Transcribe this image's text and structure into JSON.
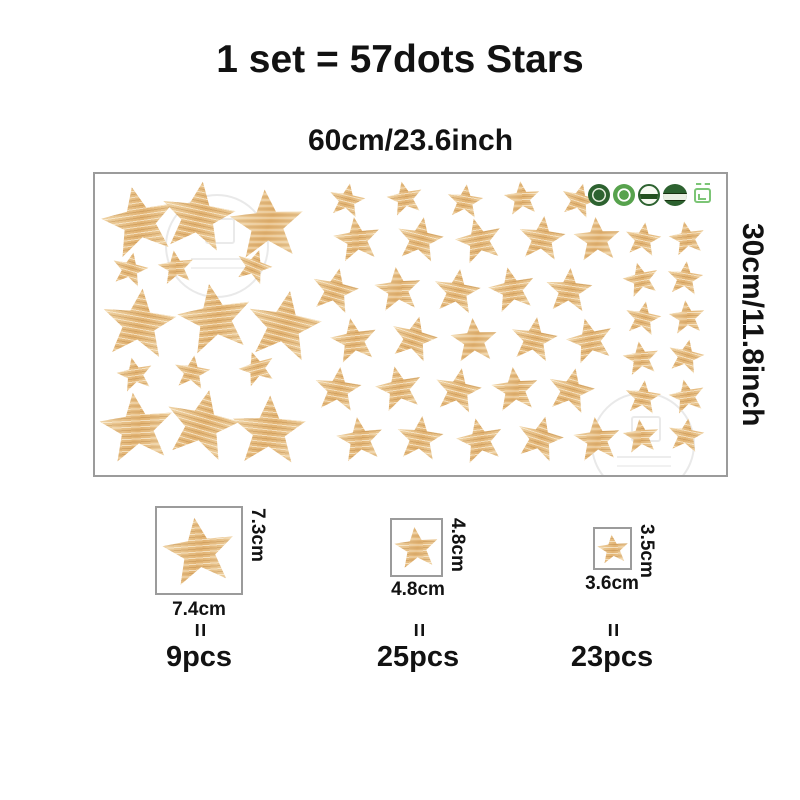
{
  "title": "1 set = 57dots Stars",
  "sheet_width_label": "60cm/23.6inch",
  "sheet_height_label": "30cm/11.8inch",
  "colors": {
    "star_base": "#e2b373",
    "star_light": "#f2dcb4",
    "badge_green_dark": "#2d6230",
    "badge_green_mid": "#57a24d",
    "badge_green_light": "#7cc576",
    "border_gray": "#9b9b9b"
  },
  "badges": {
    "icons": [
      "eco-seal-dark-icon",
      "eco-seal-green-icon",
      "eco-seal-outline-icon",
      "eco-seal-banner-icon",
      "package-cert-icon"
    ]
  },
  "sheet": {
    "star_sizes_px": {
      "l": 76,
      "m": 48,
      "s": 37
    },
    "stars": [
      {
        "x": 6.9,
        "y": 15.5,
        "s": "l",
        "r": -12
      },
      {
        "x": 16.4,
        "y": 14.0,
        "s": "l",
        "r": 8
      },
      {
        "x": 27.2,
        "y": 16.5,
        "s": "l",
        "r": -4
      },
      {
        "x": 7.0,
        "y": 49.5,
        "s": "l",
        "r": 6
      },
      {
        "x": 19.0,
        "y": 48.0,
        "s": "l",
        "r": -10
      },
      {
        "x": 30.0,
        "y": 50.0,
        "s": "l",
        "r": 10
      },
      {
        "x": 6.7,
        "y": 84.0,
        "s": "l",
        "r": -7
      },
      {
        "x": 16.9,
        "y": 83.0,
        "s": "l",
        "r": 12
      },
      {
        "x": 27.6,
        "y": 85.0,
        "s": "l",
        "r": 2
      },
      {
        "x": 5.5,
        "y": 31.5,
        "s": "s",
        "r": 12
      },
      {
        "x": 12.8,
        "y": 31.0,
        "s": "s",
        "r": -8
      },
      {
        "x": 25.2,
        "y": 30.5,
        "s": "s",
        "r": 18
      },
      {
        "x": 6.3,
        "y": 66.5,
        "s": "s",
        "r": -12
      },
      {
        "x": 15.3,
        "y": 65.8,
        "s": "s",
        "r": 8
      },
      {
        "x": 25.7,
        "y": 64.5,
        "s": "s",
        "r": -18
      },
      {
        "x": 40.0,
        "y": 8.5,
        "s": "s",
        "r": 10
      },
      {
        "x": 49.1,
        "y": 8.0,
        "s": "s",
        "r": -12
      },
      {
        "x": 58.6,
        "y": 9.0,
        "s": "s",
        "r": 6
      },
      {
        "x": 67.7,
        "y": 8.0,
        "s": "s",
        "r": -6
      },
      {
        "x": 76.7,
        "y": 8.5,
        "s": "s",
        "r": 14
      },
      {
        "x": 41.6,
        "y": 21.5,
        "s": "m",
        "r": -8
      },
      {
        "x": 51.5,
        "y": 21.5,
        "s": "m",
        "r": 10
      },
      {
        "x": 60.9,
        "y": 21.8,
        "s": "m",
        "r": -14
      },
      {
        "x": 70.9,
        "y": 21.3,
        "s": "m",
        "r": 6
      },
      {
        "x": 79.5,
        "y": 21.6,
        "s": "m",
        "r": -4
      },
      {
        "x": 38.1,
        "y": 38.5,
        "s": "m",
        "r": 12
      },
      {
        "x": 48.0,
        "y": 38.2,
        "s": "m",
        "r": -6
      },
      {
        "x": 57.3,
        "y": 38.8,
        "s": "m",
        "r": 8
      },
      {
        "x": 66.1,
        "y": 38.3,
        "s": "m",
        "r": -12
      },
      {
        "x": 75.1,
        "y": 38.6,
        "s": "m",
        "r": 4
      },
      {
        "x": 41.0,
        "y": 55.0,
        "s": "m",
        "r": -10
      },
      {
        "x": 50.5,
        "y": 54.6,
        "s": "m",
        "r": 14
      },
      {
        "x": 60.0,
        "y": 55.2,
        "s": "m",
        "r": -4
      },
      {
        "x": 69.5,
        "y": 54.8,
        "s": "m",
        "r": 8
      },
      {
        "x": 78.5,
        "y": 55.1,
        "s": "m",
        "r": -14
      },
      {
        "x": 38.5,
        "y": 71.5,
        "s": "m",
        "r": 6
      },
      {
        "x": 48.2,
        "y": 71.2,
        "s": "m",
        "r": -12
      },
      {
        "x": 57.5,
        "y": 71.8,
        "s": "m",
        "r": 10
      },
      {
        "x": 66.5,
        "y": 71.3,
        "s": "m",
        "r": -6
      },
      {
        "x": 75.5,
        "y": 71.6,
        "s": "m",
        "r": 12
      },
      {
        "x": 42.0,
        "y": 88.0,
        "s": "m",
        "r": -8
      },
      {
        "x": 51.5,
        "y": 87.6,
        "s": "m",
        "r": 6
      },
      {
        "x": 61.0,
        "y": 88.3,
        "s": "m",
        "r": -12
      },
      {
        "x": 70.5,
        "y": 87.8,
        "s": "m",
        "r": 14
      },
      {
        "x": 79.5,
        "y": 88.1,
        "s": "m",
        "r": -6
      },
      {
        "x": 86.8,
        "y": 21.5,
        "s": "s",
        "r": 8
      },
      {
        "x": 93.8,
        "y": 21.2,
        "s": "s",
        "r": -10
      },
      {
        "x": 86.5,
        "y": 35.0,
        "s": "s",
        "r": -14
      },
      {
        "x": 93.5,
        "y": 34.7,
        "s": "s",
        "r": 6
      },
      {
        "x": 86.8,
        "y": 48.0,
        "s": "s",
        "r": 10
      },
      {
        "x": 93.8,
        "y": 47.6,
        "s": "s",
        "r": -6
      },
      {
        "x": 86.5,
        "y": 61.0,
        "s": "s",
        "r": -8
      },
      {
        "x": 93.6,
        "y": 60.6,
        "s": "s",
        "r": 12
      },
      {
        "x": 86.8,
        "y": 74.0,
        "s": "s",
        "r": 6
      },
      {
        "x": 93.8,
        "y": 73.6,
        "s": "s",
        "r": -12
      },
      {
        "x": 86.5,
        "y": 87.0,
        "s": "s",
        "r": -6
      },
      {
        "x": 93.6,
        "y": 86.6,
        "s": "s",
        "r": 8
      }
    ]
  },
  "legend": {
    "items": [
      {
        "size": "l",
        "height_label": "7.3cm",
        "width_label": "7.4cm",
        "equals_sign": "=",
        "count_label": "9pcs"
      },
      {
        "size": "m",
        "height_label": "4.8cm",
        "width_label": "4.8cm",
        "equals_sign": "=",
        "count_label": "25pcs"
      },
      {
        "size": "s",
        "height_label": "3.5cm",
        "width_label": "3.6cm",
        "equals_sign": "=",
        "count_label": "23pcs"
      }
    ]
  }
}
